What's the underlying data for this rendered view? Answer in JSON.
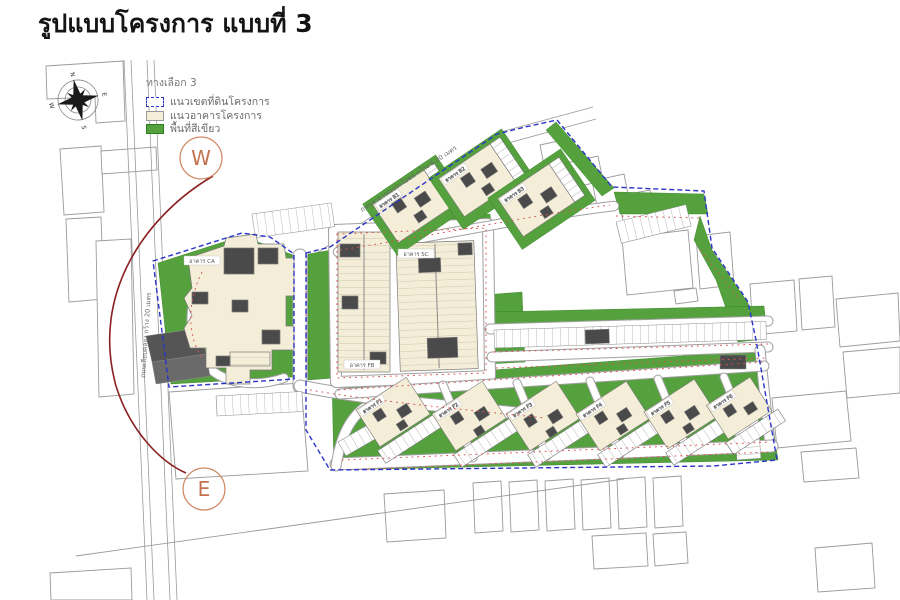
{
  "page": {
    "title": "รูปแบบโครงการ แบบที่ 3"
  },
  "legend": {
    "title": "ทางเลือก 3",
    "items": [
      {
        "label": "แนวเขตที่ดินโครงการ"
      },
      {
        "label": "แนวอาคารโครงการ"
      },
      {
        "label": "พื้นที่สีเขียว"
      }
    ]
  },
  "markers": {
    "west": "W",
    "east": "E"
  },
  "compass": {
    "north": "N",
    "east": "E",
    "south": "S",
    "west": "W"
  },
  "roads": {
    "left_road_label": "ถนนเลียบคลอง กว้าง 20 เมตร",
    "top_road_label": "ถนนสาธารณประโยชน์ กว้าง 6.00 เมตร"
  },
  "buildings": {
    "tags": [
      "อาคาร CA",
      "อาคาร SC",
      "อาคาร FB",
      "อาคาร B1",
      "อาคาร B2",
      "อาคาร B3",
      "อาคาร F1",
      "อาคาร F2",
      "อาคาร F3",
      "อาคาร F4",
      "อาคาร F5",
      "อาคาร F6"
    ]
  },
  "colors": {
    "boundary": "#2a35c8",
    "building": "#f4eed9",
    "green": "#55a13d",
    "arc": "#8c2020",
    "marker": "#c4724f",
    "tick": "#d95555"
  }
}
